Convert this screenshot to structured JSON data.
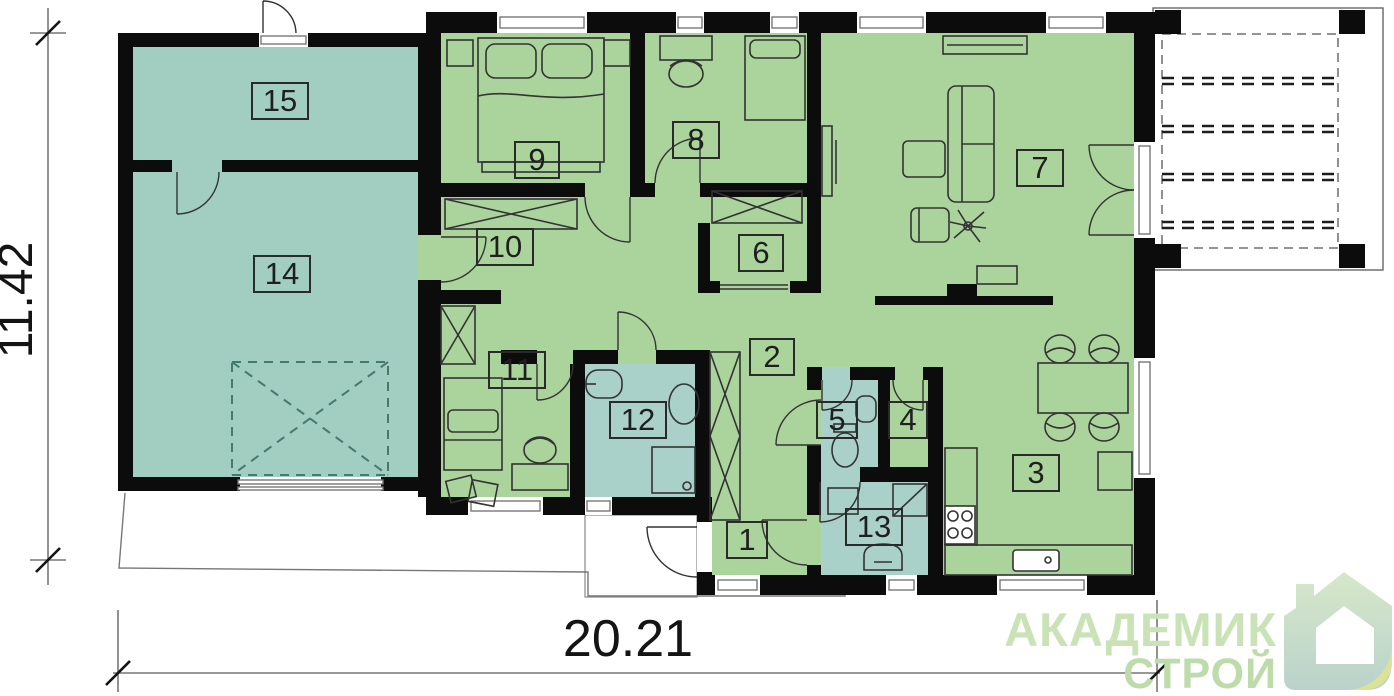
{
  "title": "floor-plan",
  "dimensions": {
    "width": "20.21",
    "height": "11.42"
  },
  "rooms": [
    {
      "number": "1"
    },
    {
      "number": "2"
    },
    {
      "number": "3"
    },
    {
      "number": "4"
    },
    {
      "number": "5"
    },
    {
      "number": "6"
    },
    {
      "number": "7"
    },
    {
      "number": "8"
    },
    {
      "number": "9"
    },
    {
      "number": "10"
    },
    {
      "number": "11"
    },
    {
      "number": "12"
    },
    {
      "number": "13"
    },
    {
      "number": "14"
    },
    {
      "number": "15"
    }
  ],
  "logo": {
    "line1": "АКАДЕМИК",
    "line2": "СТРОЙ"
  },
  "colors": {
    "wall": "#0c0c0c",
    "green": "#abd49d",
    "teal": "#a2cec1",
    "bath": "#a9d0c9",
    "dash": "#44796d",
    "line": "#777777",
    "furn": "#333333",
    "label-border": "#2a2a2a",
    "label-text": "#1f1f1f",
    "dim-text": "#141414",
    "logo1": "#c9e3b7",
    "logo2": "#bddcaa",
    "house-top": "#d6e8c9",
    "house-bot": "#bad2cb",
    "fold": "#dce394"
  }
}
